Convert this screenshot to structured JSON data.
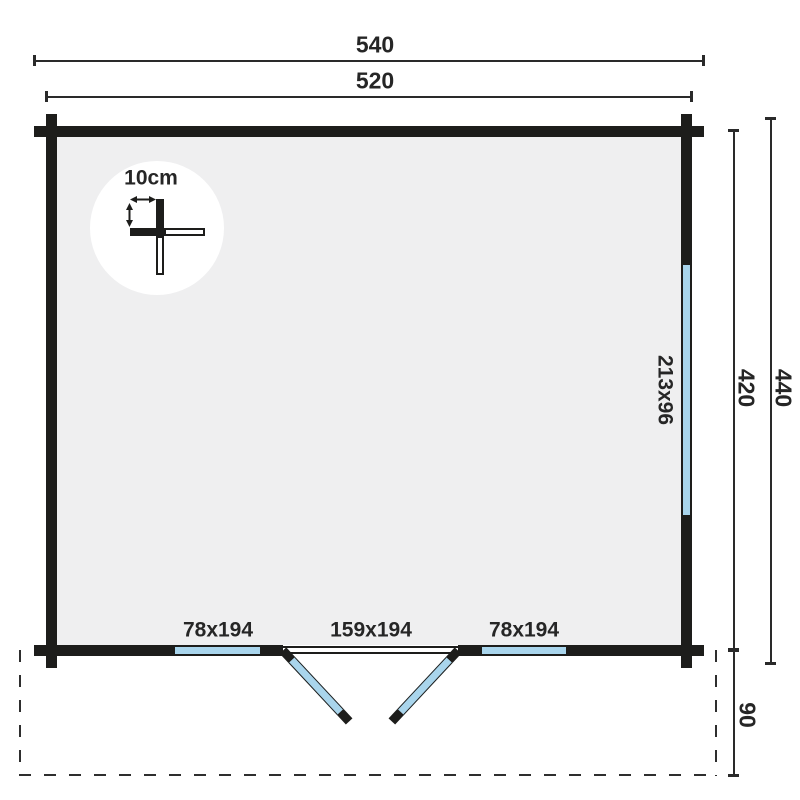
{
  "plan": {
    "width_total": "540",
    "width_walls": "520",
    "depth_walls": "420",
    "depth_total": "440",
    "canopy_depth": "90",
    "scale_label": "10cm",
    "side_window_size": "213x96",
    "front_window_left_size": "78x194",
    "door_size": "159x194",
    "front_window_right_size": "78x194"
  },
  "colors": {
    "wall": "#1d1d1b",
    "floor": "#efeff0",
    "glazing": "#a9d5ec",
    "dimension_line": "#2a2a2a",
    "background": "#ffffff"
  }
}
